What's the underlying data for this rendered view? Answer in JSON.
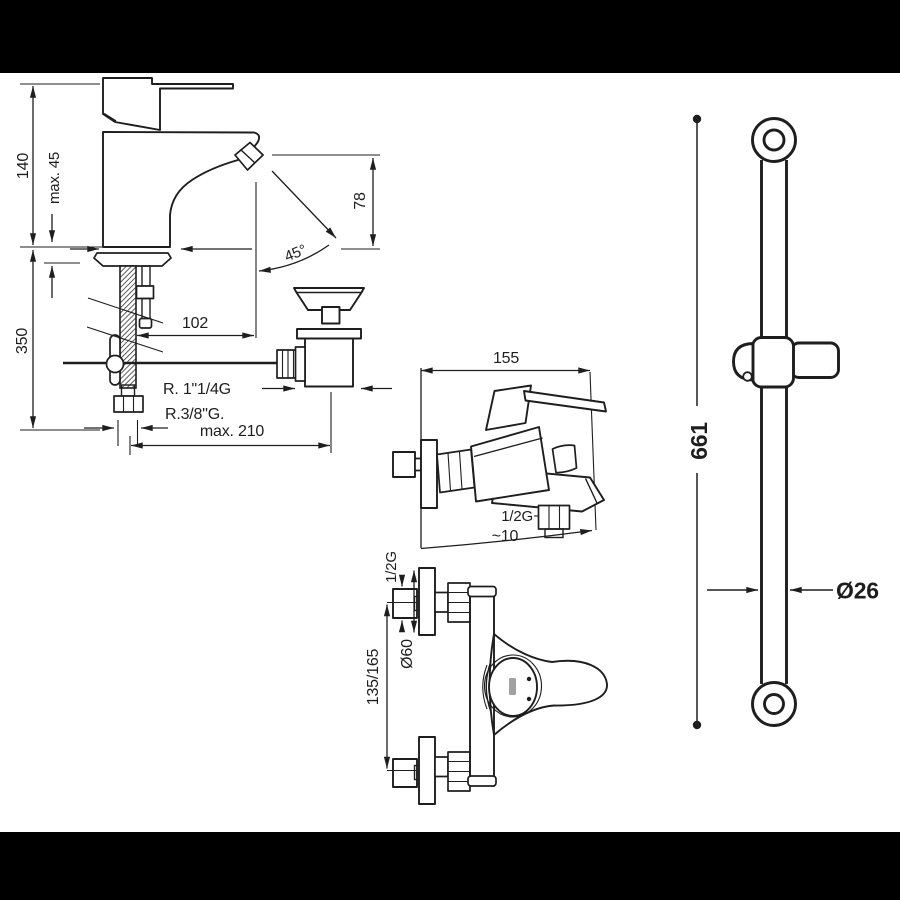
{
  "window": {
    "background": "#ffffff",
    "letterbox_color": "#000000",
    "line_color": "#1e1e1e"
  },
  "basin_mixer": {
    "description": "basin single-lever mixer technical drawing",
    "dims": {
      "total_height": "140",
      "deck_thickness": "max. 45",
      "below_deck": "350",
      "spout_height": "78",
      "spout_angle": "45°",
      "spout_reach": "102",
      "drain_thread": "R. 1\"1/4G",
      "hose_thread": "R.3/8\"G.",
      "max_reach": "max. 210"
    }
  },
  "bath_mixer_side": {
    "description": "wall-mounted bath-shower mixer, side view",
    "dims": {
      "depth": "155",
      "outlet_thread": "1/2G",
      "outlet_offset": "~10"
    }
  },
  "bath_mixer_front": {
    "description": "wall-mounted bath-shower mixer, front view",
    "dims": {
      "inlet_thread": "1/2G",
      "escutcheon_diameter": "Ø60",
      "inlet_centers": "135/165"
    }
  },
  "shower_rail": {
    "description": "shower slide rail with holder",
    "dims": {
      "rail_length": "661",
      "rail_diameter": "Ø26"
    }
  }
}
